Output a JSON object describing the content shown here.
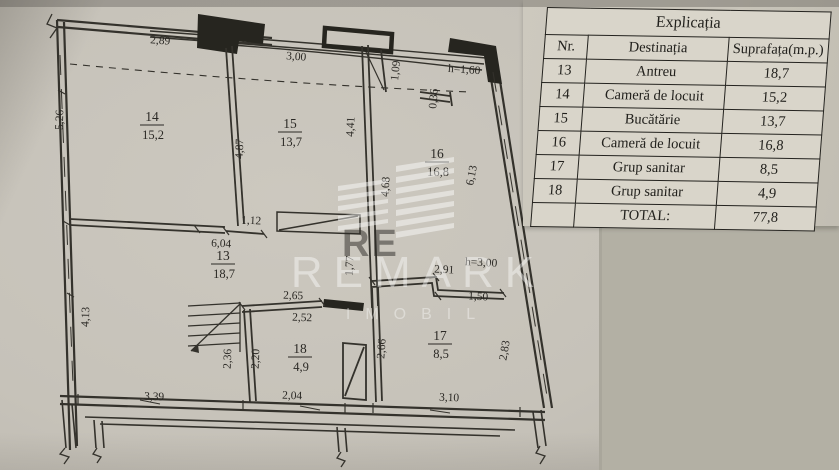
{
  "table": {
    "title": "Explicația",
    "headers": {
      "nr": "Nr.",
      "dest": "Destinația",
      "area": "Suprafața(m.p.)"
    },
    "rows": [
      {
        "nr": "13",
        "dest": "Antreu",
        "area": "18,7"
      },
      {
        "nr": "14",
        "dest": "Cameră de locuit",
        "area": "15,2"
      },
      {
        "nr": "15",
        "dest": "Bucătărie",
        "area": "13,7"
      },
      {
        "nr": "16",
        "dest": "Cameră de locuit",
        "area": "16,8"
      },
      {
        "nr": "17",
        "dest": "Grup sanitar",
        "area": "8,5"
      },
      {
        "nr": "18",
        "dest": "Grup sanitar",
        "area": "4,9"
      }
    ],
    "total_label": "TOTAL:",
    "total_value": "77,8"
  },
  "plan": {
    "rooms": [
      {
        "id": "14",
        "area": "15,2"
      },
      {
        "id": "15",
        "area": "13,7"
      },
      {
        "id": "16",
        "area": "16,8"
      },
      {
        "id": "13",
        "area": "18,7"
      },
      {
        "id": "17",
        "area": "8,5"
      },
      {
        "id": "18",
        "area": "4,9"
      }
    ],
    "dims": {
      "d289": "2,89",
      "d300": "3,00",
      "d109": "1,09",
      "h160": "h=1,60",
      "d036": "0,36",
      "d526": "5,26",
      "d487": "4,87",
      "d441": "4,41",
      "d468": "4,68",
      "d613": "6,13",
      "d604": "6,04",
      "d112": "1,12",
      "d177": "1,77",
      "d291": "2,91",
      "h300": "h=3,00",
      "d150": "1,50",
      "d413": "4,13",
      "d236": "2,36",
      "d220": "2,20",
      "d265": "2,65",
      "d252": "2,52",
      "d266": "2,66",
      "d283": "2,83",
      "d339": "3,39",
      "d204": "2,04",
      "d310": "3,10"
    }
  },
  "watermark": {
    "brand": "REMARK",
    "sub": "IMOBIL",
    "logo_letters": "RE"
  },
  "colors": {
    "flat_background": "#b3b0a4",
    "plan_paper": "#c6c2b9",
    "table_paper": "#c8c4b9",
    "table_cell": "#d9d5ca",
    "ink": "#2b2925"
  }
}
